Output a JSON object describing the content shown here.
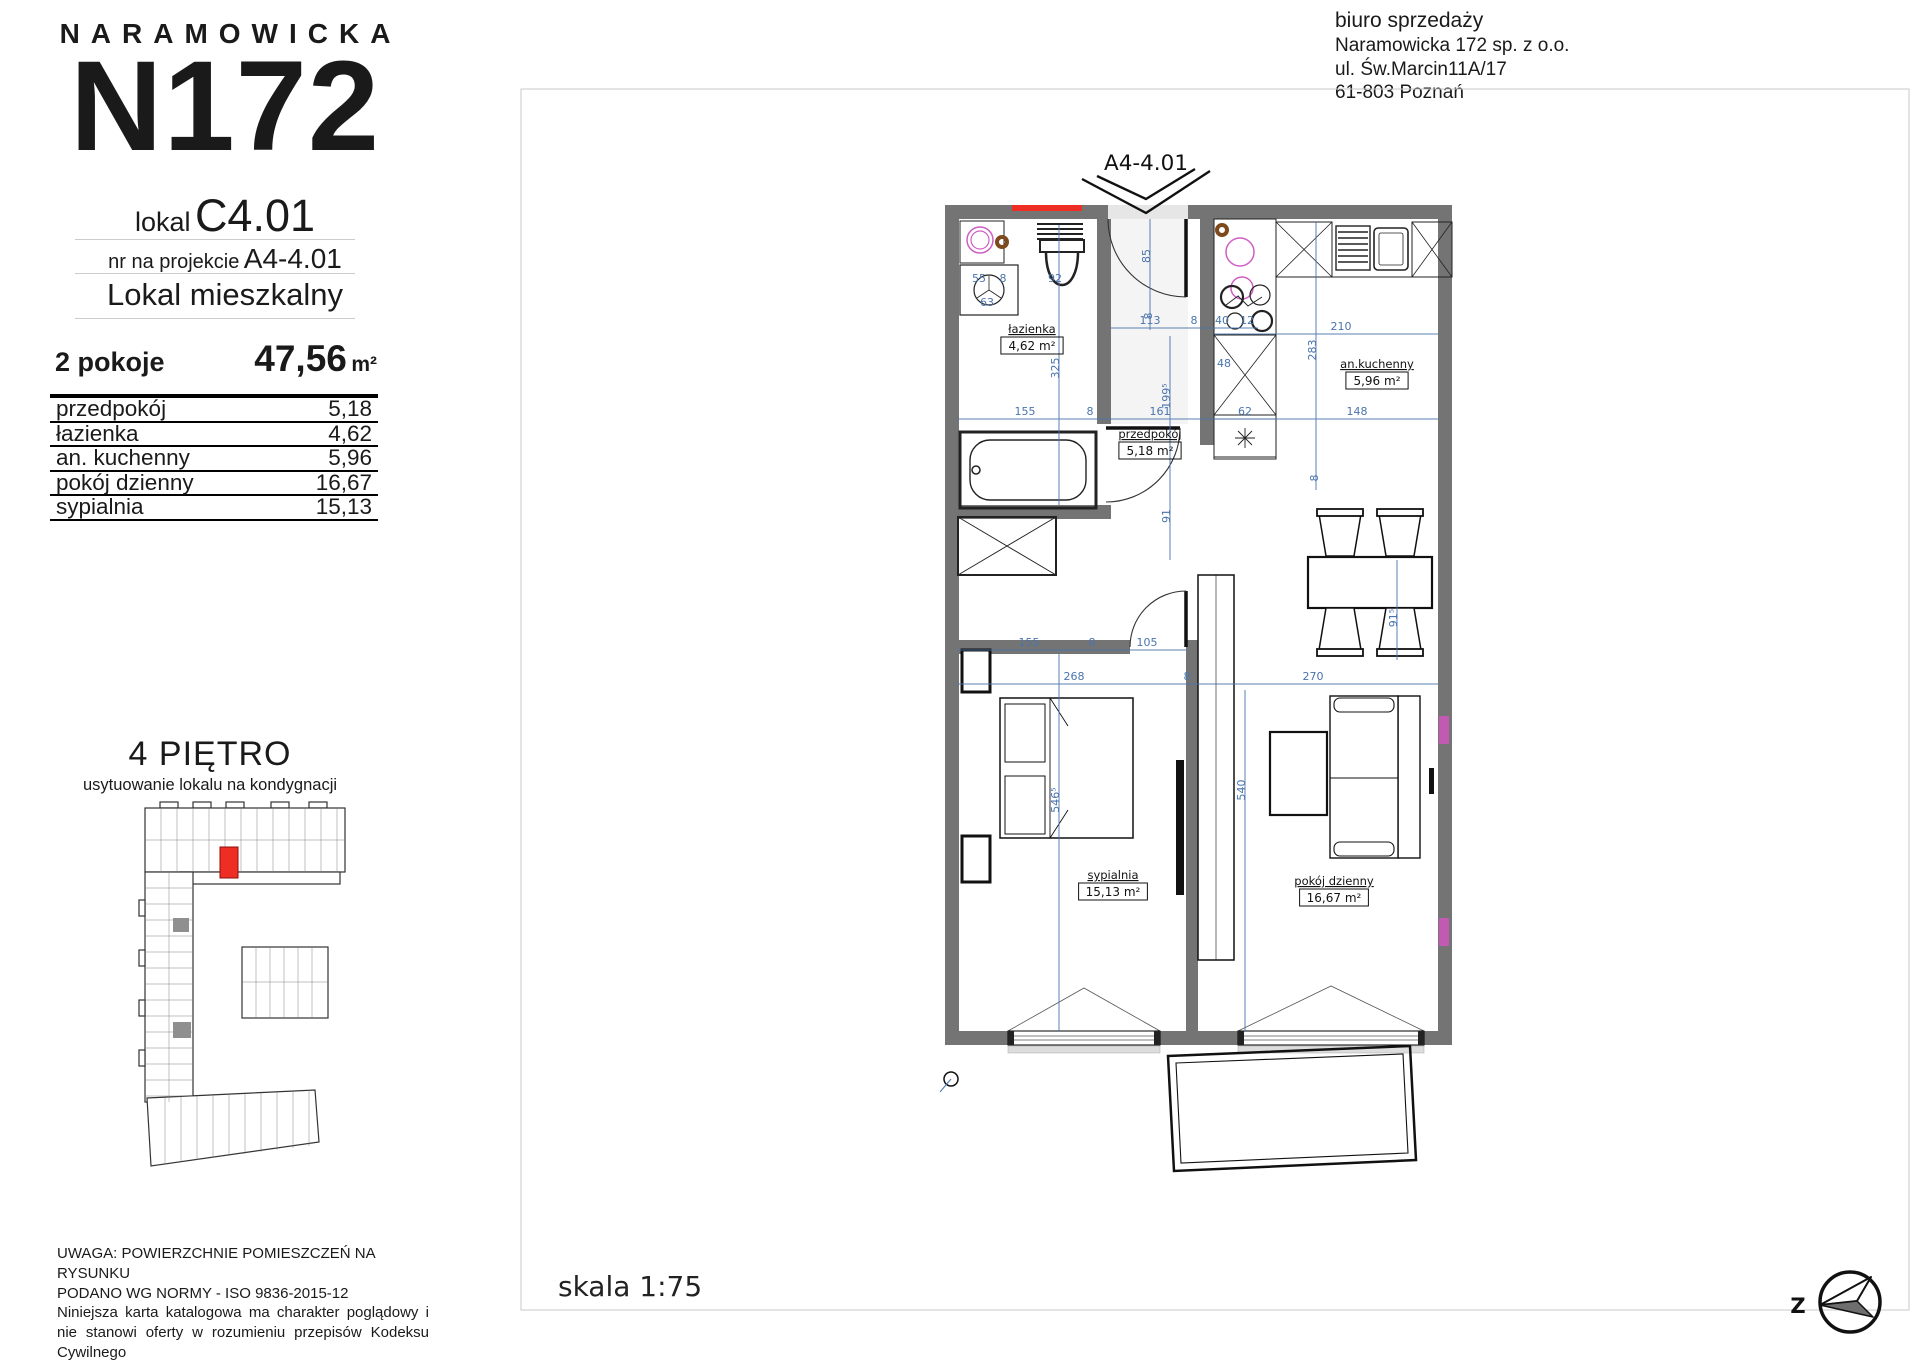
{
  "brand": {
    "name": "NARAMOWICKA",
    "logo": "N172"
  },
  "header_right": {
    "title": "biuro sprzedaży",
    "lines": [
      "Naramowicka 172 sp. z o.o.",
      "ul. Św.Marcin11A/17",
      "61-803 Poznań"
    ]
  },
  "unit": {
    "lokal_label": "lokal",
    "lokal_value": "C4.01",
    "project_label": "nr na projekcie",
    "project_value": "A4-4.01",
    "type": "Lokal mieszkalny",
    "rooms_summary": "2 pokoje",
    "total_area": "47,56",
    "total_area_unit": "m²"
  },
  "rooms_table": [
    {
      "name": "przedpokój",
      "area": "5,18"
    },
    {
      "name": "łazienka",
      "area": "4,62"
    },
    {
      "name": "an. kuchenny",
      "area": "5,96"
    },
    {
      "name": "pokój dzienny",
      "area": "16,67"
    },
    {
      "name": "sypialnia",
      "area": "15,13"
    }
  ],
  "floor_location": {
    "title": "4 PIĘTRO",
    "subtitle": "usytuowanie lokalu na kondygnacji"
  },
  "plan": {
    "unit_marker": "A4-4.01",
    "scale_label": "skala 1:75",
    "compass_letter": "Z",
    "room_labels": [
      {
        "name": "łazienka",
        "area": "4,62 m²",
        "x": 1032,
        "y": 333
      },
      {
        "name": "przedpokój",
        "area": "5,18 m²",
        "x": 1150,
        "y": 438
      },
      {
        "name": "an.kuchenny",
        "area": "5,96 m²",
        "x": 1377,
        "y": 368
      },
      {
        "name": "sypialnia",
        "area": "15,13 m²",
        "x": 1113,
        "y": 879
      },
      {
        "name": "pokój dzienny",
        "area": "16,67 m²",
        "x": 1334,
        "y": 885
      }
    ],
    "dimensions": [
      {
        "text": "85",
        "x": 1150,
        "y": 256,
        "rot": -90
      },
      {
        "text": "8",
        "x": 1152,
        "y": 316,
        "rot": -90
      },
      {
        "text": "55",
        "x": 979,
        "y": 282
      },
      {
        "text": "8",
        "x": 1003,
        "y": 282
      },
      {
        "text": "63",
        "x": 987,
        "y": 306
      },
      {
        "text": "92",
        "x": 1055,
        "y": 282
      },
      {
        "text": "325",
        "x": 1059,
        "y": 368,
        "rot": -90
      },
      {
        "text": "113",
        "x": 1150,
        "y": 324
      },
      {
        "text": "8",
        "x": 1194,
        "y": 324
      },
      {
        "text": "40",
        "x": 1222,
        "y": 324
      },
      {
        "text": "12",
        "x": 1247,
        "y": 324
      },
      {
        "text": "48",
        "x": 1224,
        "y": 367
      },
      {
        "text": "199⁵",
        "x": 1170,
        "y": 396,
        "rot": -90
      },
      {
        "text": "210",
        "x": 1341,
        "y": 330
      },
      {
        "text": "283",
        "x": 1316,
        "y": 350,
        "rot": -90
      },
      {
        "text": "155",
        "x": 1025,
        "y": 415
      },
      {
        "text": "8",
        "x": 1090,
        "y": 415
      },
      {
        "text": "161",
        "x": 1160,
        "y": 415
      },
      {
        "text": "62",
        "x": 1245,
        "y": 415
      },
      {
        "text": "148",
        "x": 1357,
        "y": 415
      },
      {
        "text": "8",
        "x": 1318,
        "y": 478,
        "rot": -90
      },
      {
        "text": "91",
        "x": 1170,
        "y": 516,
        "rot": -90
      },
      {
        "text": "155",
        "x": 1029,
        "y": 646
      },
      {
        "text": "8",
        "x": 1092,
        "y": 646
      },
      {
        "text": "105",
        "x": 1147,
        "y": 646
      },
      {
        "text": "268",
        "x": 1074,
        "y": 680
      },
      {
        "text": "8",
        "x": 1187,
        "y": 680
      },
      {
        "text": "270",
        "x": 1313,
        "y": 680
      },
      {
        "text": "91⁵",
        "x": 1397,
        "y": 618,
        "rot": -90
      },
      {
        "text": "546⁵",
        "x": 1059,
        "y": 800,
        "rot": -90
      },
      {
        "text": "540",
        "x": 1245,
        "y": 790,
        "rot": -90
      }
    ]
  },
  "disclaimer": {
    "line1": "UWAGA: POWIERZCHNIE POMIESZCZEŃ NA RYSUNKU",
    "line2": "PODANO WG NORMY - ISO 9836-2015-12",
    "paragraph": "Niniejsza karta katalogowa ma charakter poglądowy i nie stanowi oferty w rozumieniu przepisów Kodeksu Cywilnego"
  },
  "colors": {
    "wall": "#747474",
    "dim": "#4a74ad",
    "magenta": "#cf5ec4",
    "pink": "#c25ab4",
    "red": "#ee2e24",
    "brown": "#7d4a1e"
  }
}
